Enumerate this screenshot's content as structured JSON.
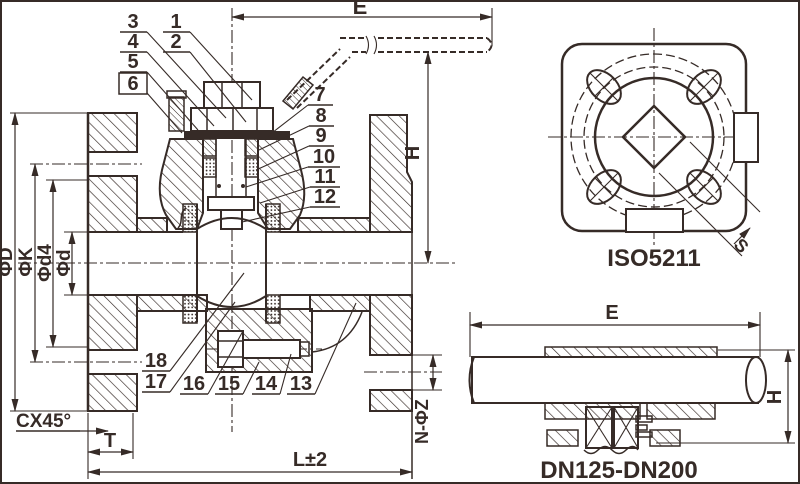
{
  "colors": {
    "ink": "#362b27",
    "paper": "#ffffff"
  },
  "main_view": {
    "callouts": [
      "1",
      "2",
      "3",
      "4",
      "5",
      "6",
      "7",
      "8",
      "9",
      "10",
      "11",
      "12",
      "13",
      "14",
      "15",
      "16",
      "17",
      "18"
    ],
    "dims": {
      "width_e": "E",
      "height_h": "H",
      "flange_od": "ΦD",
      "bolt_circle": "ΦK",
      "raised_face": "Φd4",
      "bore": "Φd",
      "chamfer": "CX45°",
      "flange_thickness": "T",
      "face_to_face": "L±2",
      "bolt_holes": "N-ΦZ"
    }
  },
  "iso_view": {
    "title": "ISO5211",
    "square_dim": "S"
  },
  "dn_view": {
    "title": "DN125-DN200",
    "width_e": "E",
    "height_h": "H"
  }
}
